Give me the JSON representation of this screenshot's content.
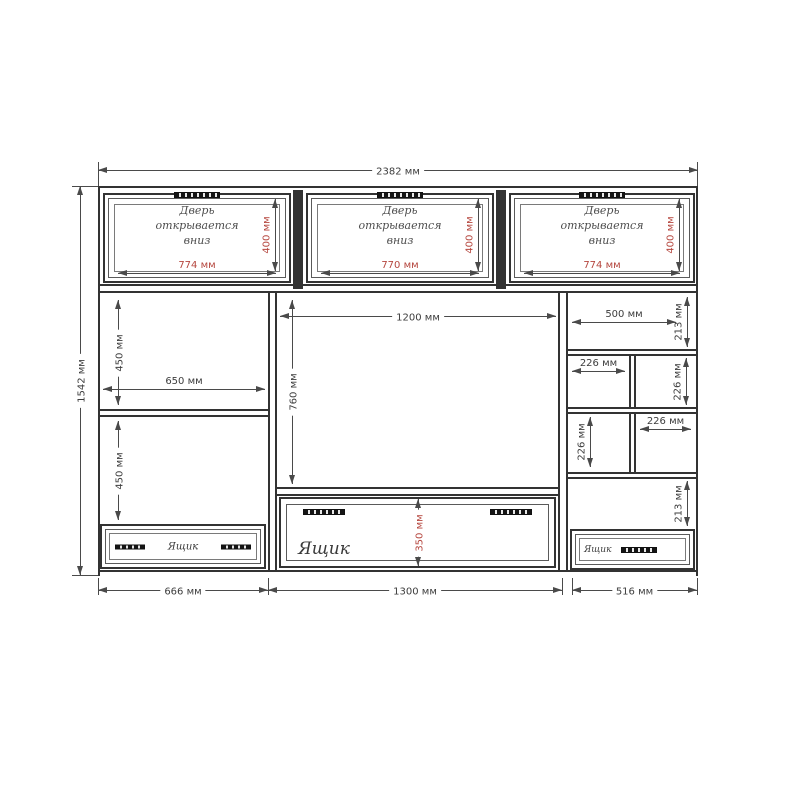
{
  "drawing": {
    "title": "furniture wall-unit assembly drawing",
    "overall_width": "2382 мм",
    "overall_height": "1542 мм"
  },
  "doors": [
    {
      "line1": "Дверь",
      "line2": "открывается",
      "line3": "вниз",
      "width": "774 мм",
      "height": "400 мм"
    },
    {
      "line1": "Дверь",
      "line2": "открывается",
      "line3": "вниз",
      "width": "770 мм",
      "height": "400 мм"
    },
    {
      "line1": "Дверь",
      "line2": "открывается",
      "line3": "вниз",
      "width": "774 мм",
      "height": "400 мм"
    }
  ],
  "left_column": {
    "upper_height": "450 мм",
    "shelf_width": "650 мм",
    "lower_height": "450 мм",
    "drawer_label": "Ящик",
    "bottom_width": "666 мм"
  },
  "center_column": {
    "niche_width": "1200 мм",
    "niche_height": "760 мм",
    "drawer_label": "Ящик",
    "drawer_height": "350 мм",
    "bottom_width": "1300 мм"
  },
  "right_column": {
    "top_width": "500 мм",
    "top_height": "213 мм",
    "cell_top_left_width": "226 мм",
    "cell_top_right_height": "226 мм",
    "cell_bottom_left_height": "226 мм",
    "cell_bottom_right_width": "226 мм",
    "lower_height": "213 мм",
    "drawer_label": "Ящик",
    "bottom_width": "516 мм"
  },
  "colors": {
    "line": "#4a4a4a",
    "wall": "#333333",
    "dimension_red": "#b5463e",
    "text_gray": "#4d4d4d"
  }
}
